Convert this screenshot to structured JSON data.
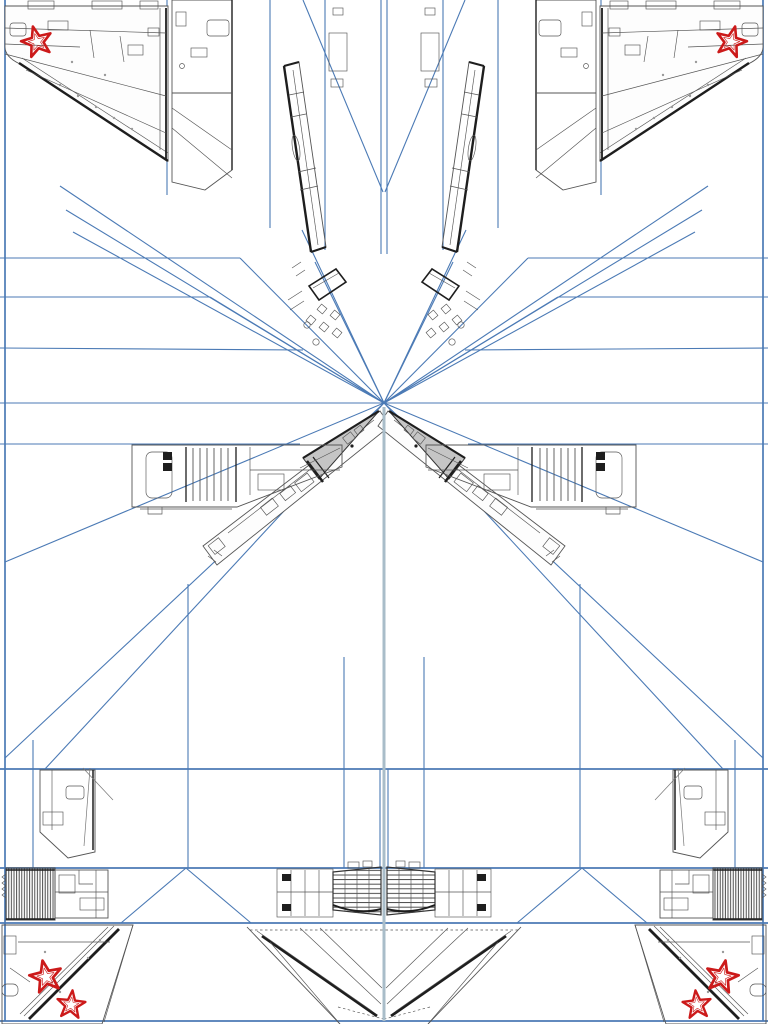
{
  "meta": {
    "document_type": "papercraft-model-template-sheet",
    "subject": "twin-tail jet fighter paper model, mirror-symmetric unfolded parts",
    "visible_text": ""
  },
  "page": {
    "width": 768,
    "height": 1024,
    "background": "#ffffff"
  },
  "colors": {
    "paper": "#ffffff",
    "construction_line": "#4b7ab5",
    "center_line": "#a9bdc9",
    "part_outline": "#555555",
    "dark_edge": "#1e1e1e",
    "fin_fill": "#efefef",
    "cone_fill": "#c5c5c5",
    "star_red": "#cc1a1a"
  },
  "stars": {
    "count": 6,
    "items": [
      {
        "location": "top-left-wing",
        "transform": "translate(37 42) rotate(-15)"
      },
      {
        "location": "top-right-wing",
        "transform": "translate(731 42) rotate(15)"
      },
      {
        "location": "bottom-left-upper",
        "transform": "translate(46 977) rotate(-12) scale(1.05)"
      },
      {
        "location": "bottom-left-lower",
        "transform": "translate(71 1005) rotate(6) scale(0.92)"
      },
      {
        "location": "bottom-right-upper",
        "transform": "translate(722 977) rotate(12) scale(1.05)"
      },
      {
        "location": "bottom-right-lower",
        "transform": "translate(697 1005) rotate(-6) scale(0.92)"
      }
    ]
  },
  "parts": [
    {
      "id": "wing-skin-upper",
      "label": "upper wing skin with star (left & right)"
    },
    {
      "id": "fuselage-spine",
      "label": "fuselage spine strip (left & right)"
    },
    {
      "id": "tail-fin",
      "label": "vertical tail fin (left & right)"
    },
    {
      "id": "cockpit-frames",
      "label": "canopy / cockpit side frames (left & right)"
    },
    {
      "id": "forward-fuselage",
      "label": "forward fuselage side with grey radome (left & right)"
    },
    {
      "id": "intake-block",
      "label": "engine intake block with slats (left & right)"
    },
    {
      "id": "turbofan-face",
      "label": "turbofan detail, bottom corners (left & right)"
    },
    {
      "id": "exhaust-nozzle",
      "label": "exhaust nozzle, bottom centre (left & right)"
    },
    {
      "id": "aft-deck",
      "label": "aft deck with flap hinges (bottom centre)"
    },
    {
      "id": "lower-wing-panel",
      "label": "lower wing panel with two stars (bottom corners)"
    }
  ]
}
